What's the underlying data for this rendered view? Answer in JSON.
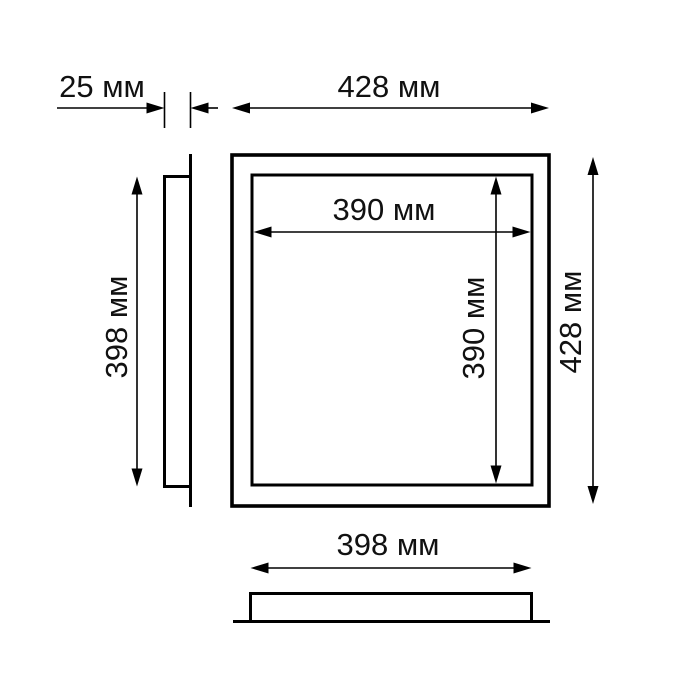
{
  "drawing": {
    "type": "technical-dimension-diagram",
    "subject": "square-panel",
    "unit": "мм",
    "colors": {
      "background": "#ffffff",
      "line": "#000000",
      "text": "#111111"
    },
    "views": {
      "side_profile": "side view (left)",
      "front_face": "front view (center)",
      "bottom_profile": "bottom view"
    },
    "dims": {
      "thickness": {
        "value": 25,
        "label": "25 мм"
      },
      "outer_width": {
        "value": 428,
        "label": "428 мм"
      },
      "outer_height": {
        "value": 428,
        "label": "428 мм"
      },
      "body_height": {
        "value": 398,
        "label": "398 мм"
      },
      "body_width": {
        "value": 398,
        "label": "398 мм"
      },
      "inner_width": {
        "value": 390,
        "label": "390 мм"
      },
      "inner_height": {
        "value": 390,
        "label": "390 мм"
      }
    }
  }
}
